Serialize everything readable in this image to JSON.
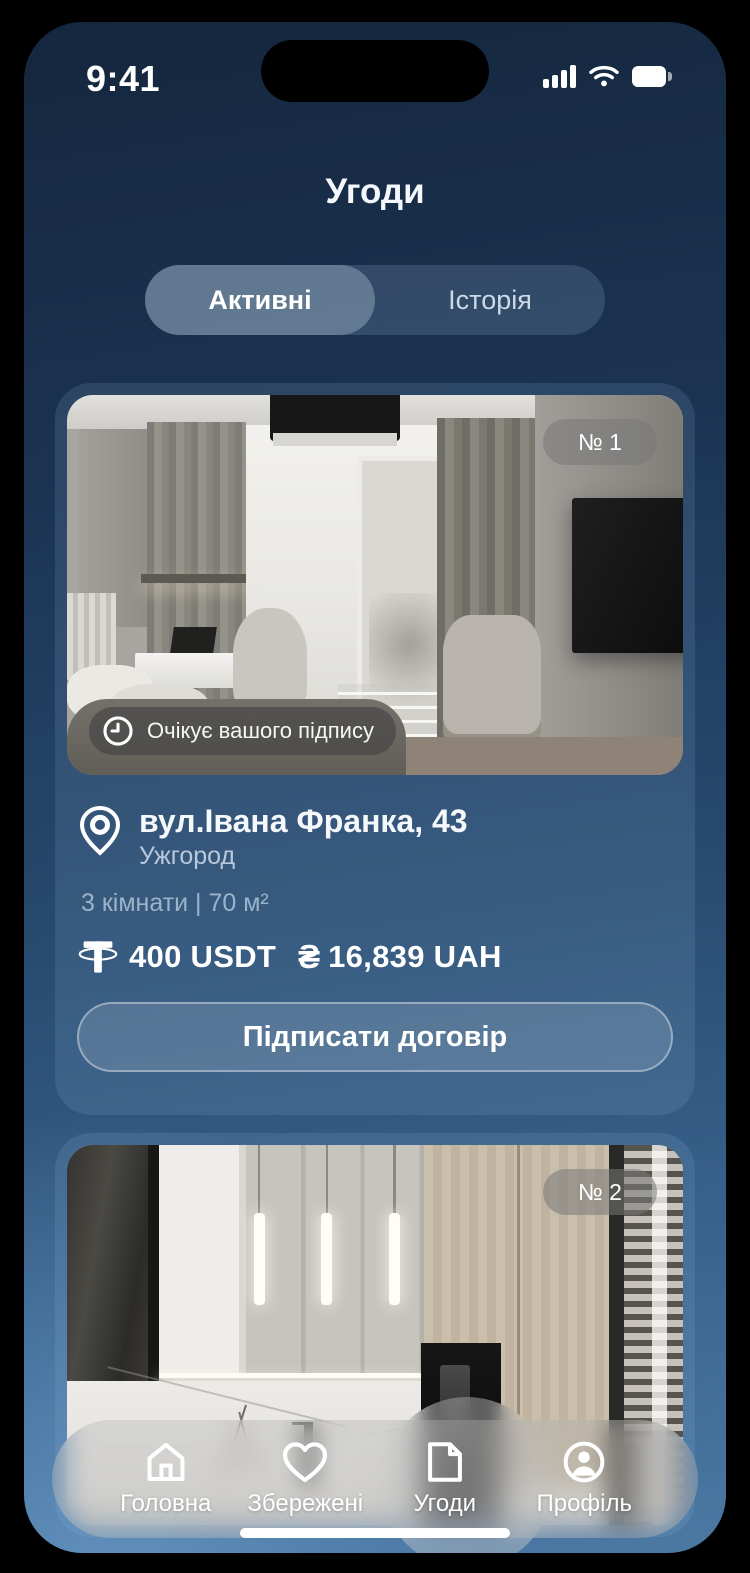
{
  "status_bar": {
    "time": "9:41"
  },
  "header": {
    "title": "Угоди"
  },
  "tabs": {
    "active_label": "Активні",
    "history_label": "Історія"
  },
  "deals": [
    {
      "badge": "№ 1",
      "status": "Очікує вашого підпису",
      "address": "вул.Івана Франка, 43",
      "city": "Ужгород",
      "details": "3 кімнати | 70 м²",
      "price_usdt": "400 USDT",
      "uah_symbol": "₴",
      "price_uah": "16,839 UAH",
      "action_label": "Підписати договір"
    },
    {
      "badge": "№ 2"
    }
  ],
  "nav": {
    "items": [
      {
        "label": "Головна",
        "icon": "home-icon",
        "active": false
      },
      {
        "label": "Збережені",
        "icon": "heart-icon",
        "active": false
      },
      {
        "label": "Угоди",
        "icon": "document-icon",
        "active": true
      },
      {
        "label": "Профіль",
        "icon": "profile-icon",
        "active": false
      }
    ]
  },
  "colors": {
    "background_top": "#15273e",
    "background_bottom": "#4b79a4",
    "card_tint": "rgba(150,188,224,0.15)",
    "status_pill": "rgba(66,66,66,0.62)",
    "text_primary": "#f5f8fb",
    "text_secondary": "#b9c9db",
    "text_muted": "#9db3ca"
  }
}
